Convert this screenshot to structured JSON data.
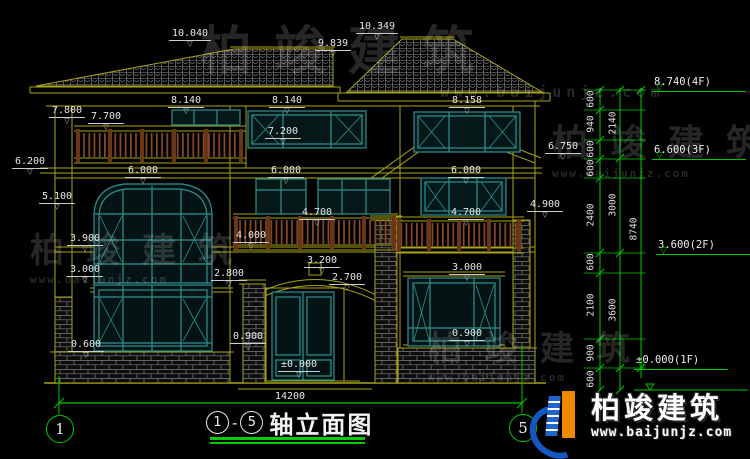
{
  "drawing_title": {
    "axis_start": "1",
    "dash": "-",
    "axis_end": "5",
    "text": "轴立面图"
  },
  "bottom_dimension": "14200",
  "axis_bubbles": {
    "left": "1",
    "right": "5"
  },
  "annotations": [
    {
      "t": "10.040",
      "x": 190,
      "y": 23
    },
    {
      "t": "10.349",
      "x": 377,
      "y": 16
    },
    {
      "t": "9.839",
      "x": 333,
      "y": 33
    },
    {
      "t": "8.140",
      "x": 186,
      "y": 90
    },
    {
      "t": "8.140",
      "x": 287,
      "y": 90
    },
    {
      "t": "8.158",
      "x": 467,
      "y": 90
    },
    {
      "t": "7.800",
      "x": 67,
      "y": 100
    },
    {
      "t": "7.700",
      "x": 106,
      "y": 106
    },
    {
      "t": "7.200",
      "x": 283,
      "y": 121
    },
    {
      "t": "6.750",
      "x": 563,
      "y": 136
    },
    {
      "t": "6.200",
      "x": 30,
      "y": 151
    },
    {
      "t": "6.000",
      "x": 143,
      "y": 160
    },
    {
      "t": "6.000",
      "x": 286,
      "y": 160
    },
    {
      "t": "6.000",
      "x": 466,
      "y": 160
    },
    {
      "t": "5.100",
      "x": 57,
      "y": 186
    },
    {
      "t": "4.900",
      "x": 545,
      "y": 194
    },
    {
      "t": "4.700",
      "x": 317,
      "y": 202
    },
    {
      "t": "4.700",
      "x": 466,
      "y": 202
    },
    {
      "t": "4.000",
      "x": 251,
      "y": 225
    },
    {
      "t": "3.900",
      "x": 85,
      "y": 228
    },
    {
      "t": "3.200",
      "x": 322,
      "y": 250
    },
    {
      "t": "3.000",
      "x": 85,
      "y": 259
    },
    {
      "t": "3.000",
      "x": 467,
      "y": 257
    },
    {
      "t": "2.800",
      "x": 229,
      "y": 263
    },
    {
      "t": "2.700",
      "x": 347,
      "y": 267
    },
    {
      "t": "0.900",
      "x": 248,
      "y": 326
    },
    {
      "t": "0.900",
      "x": 467,
      "y": 323
    },
    {
      "t": "0.600",
      "x": 86,
      "y": 334
    },
    {
      "t": "±0.000",
      "x": 299,
      "y": 354
    }
  ],
  "right_dimension_chains": {
    "segments_inner": [
      {
        "t": "600",
        "x": 591,
        "y": 99
      },
      {
        "t": "940",
        "x": 591,
        "y": 124
      },
      {
        "t": "600",
        "x": 591,
        "y": 149
      },
      {
        "t": "600",
        "x": 591,
        "y": 168
      },
      {
        "t": "2400",
        "x": 591,
        "y": 215
      },
      {
        "t": "600",
        "x": 591,
        "y": 262
      },
      {
        "t": "2100",
        "x": 591,
        "y": 305
      },
      {
        "t": "900",
        "x": 591,
        "y": 353
      },
      {
        "t": "600",
        "x": 591,
        "y": 379
      }
    ],
    "segments_middle": [
      {
        "t": "2140",
        "x": 613,
        "y": 123
      },
      {
        "t": "3000",
        "x": 613,
        "y": 205
      },
      {
        "t": "3600",
        "x": 613,
        "y": 310
      }
    ],
    "segments_outer": [
      {
        "t": "8740",
        "x": 634,
        "y": 229
      }
    ],
    "levels": [
      {
        "t": "8.740(4F)",
        "x": 652,
        "y": 72
      },
      {
        "t": "6.600(3F)",
        "x": 652,
        "y": 140
      },
      {
        "t": "3.600(2F)",
        "x": 656,
        "y": 235
      },
      {
        "t": "±0.000(1F)",
        "x": 634,
        "y": 350
      }
    ]
  },
  "watermarks": [
    {
      "t": "柏竣建筑",
      "sub": "www.baijunjz.com",
      "x": 200,
      "y": 26,
      "size": 52,
      "cls": "wm-big"
    },
    {
      "t": "柏竣建筑",
      "sub": "www.baijunjz.com",
      "x": 30,
      "y": 234,
      "size": 34
    },
    {
      "t": "柏竣建筑",
      "sub": "www.baijunjz.com",
      "x": 552,
      "y": 126,
      "size": 36
    },
    {
      "t": "柏竣建筑",
      "sub": "www.baijunjz.com",
      "x": 428,
      "y": 332,
      "size": 34
    }
  ],
  "logo": {
    "name": "柏竣建筑",
    "url": "www.baijunjz.com"
  },
  "colors": {
    "background": "#000000",
    "linework_olive": "#a8a416",
    "window_teal": "#2f9090",
    "railing_brown": "#8a4a26",
    "dimension_green": "#00c800",
    "text_white": "#e8e8e8",
    "logo_blue": "#1557c0",
    "logo_orange": "#f28a00"
  }
}
